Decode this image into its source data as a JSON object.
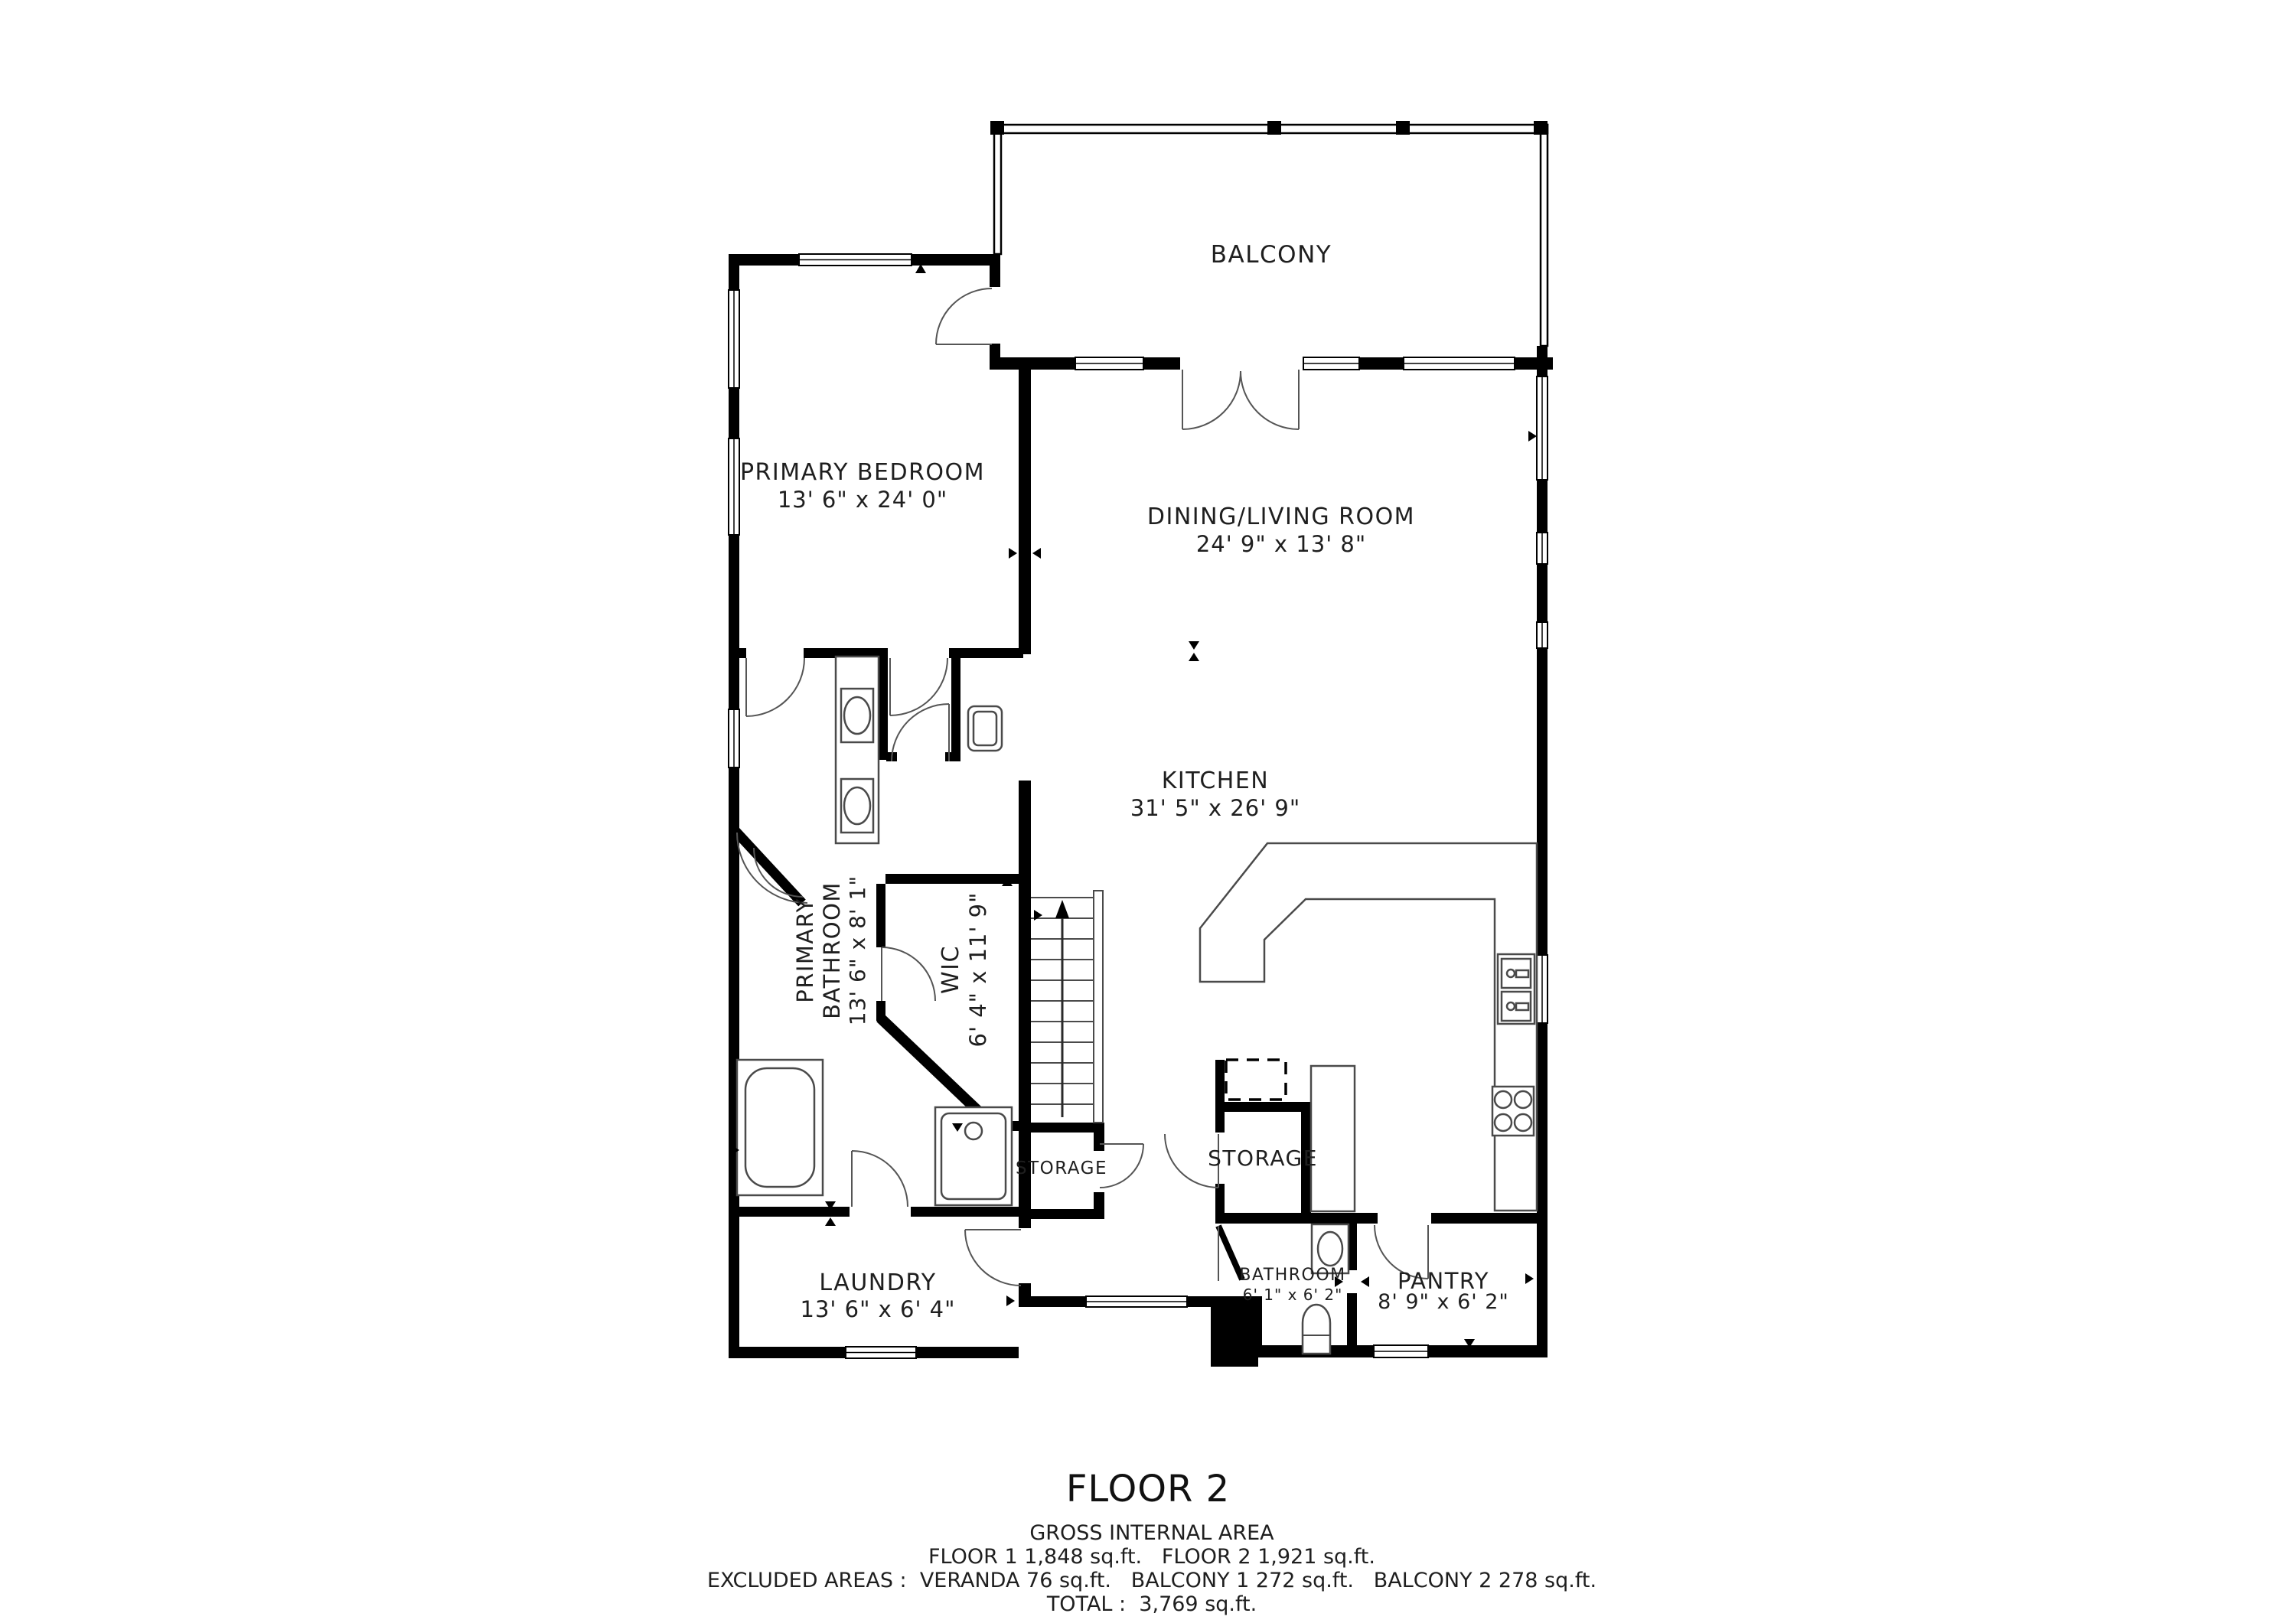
{
  "colors": {
    "wall": "#000000",
    "line": "#4a4a4a",
    "text": "#1f1f1f",
    "background": "#ffffff"
  },
  "rooms": {
    "balcony": {
      "name": "BALCONY"
    },
    "primary_bedroom": {
      "name": "PRIMARY BEDROOM",
      "dims": "13' 6\" x 24' 0\""
    },
    "dining_living": {
      "name": "DINING/LIVING ROOM",
      "dims": "24' 9\" x 13' 8\""
    },
    "kitchen": {
      "name": "KITCHEN",
      "dims": "31' 5\" x 26' 9\""
    },
    "primary_bathroom": {
      "name_line1": "PRIMARY",
      "name_line2": "BATHROOM",
      "dims": "13' 6\" x 8' 1\""
    },
    "wic": {
      "name": "WIC",
      "dims": "6' 4\" x 11' 9\""
    },
    "storage_left": {
      "name": "STORAGE"
    },
    "storage_right": {
      "name": "STORAGE"
    },
    "laundry": {
      "name": "LAUNDRY",
      "dims": "13' 6\" x 6' 4\""
    },
    "bathroom": {
      "name": "BATHROOM",
      "dims": "6' 1\" x 6' 2\""
    },
    "pantry": {
      "name": "PANTRY",
      "dims": "8' 9\" x 6' 2\""
    }
  },
  "footer": {
    "floor_title": "FLOOR 2",
    "gross_label": "GROSS INTERNAL AREA",
    "floors_line": "FLOOR 1 1,848 sq.ft.   FLOOR 2 1,921 sq.ft.",
    "excluded_line": "EXCLUDED AREAS :  VERANDA 76 sq.ft.   BALCONY 1 272 sq.ft.   BALCONY 2 278 sq.ft.",
    "total_line": "TOTAL :  3,769 sq.ft."
  }
}
